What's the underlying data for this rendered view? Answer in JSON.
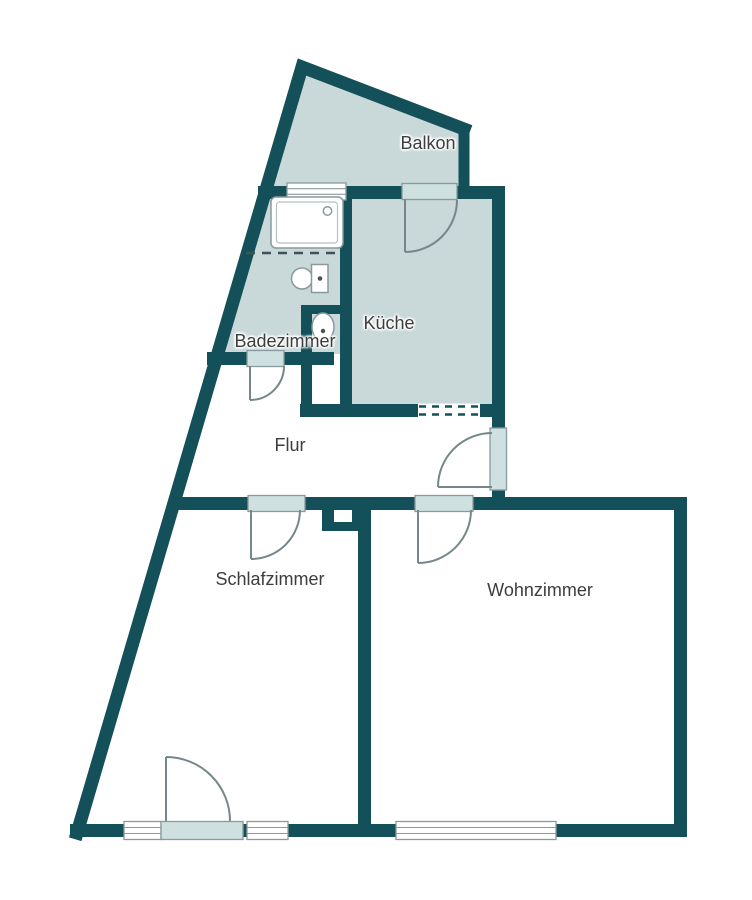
{
  "floorplan": {
    "type": "apartment-floor-plan",
    "rooms": {
      "balkon": {
        "label": "Balkon",
        "shaded": true
      },
      "kueche": {
        "label": "Küche",
        "shaded": true
      },
      "badezimmer": {
        "label": "Badezimmer",
        "shaded": true
      },
      "flur": {
        "label": "Flur",
        "shaded": false
      },
      "schlafzimmer": {
        "label": "Schlafzimmer",
        "shaded": false
      },
      "wohnzimmer": {
        "label": "Wohnzimmer",
        "shaded": false
      }
    },
    "symbols": [
      "shower-tub",
      "toilet",
      "sink",
      "door-swing",
      "window",
      "chimney",
      "pass-through-hatch",
      "sloped-ceiling-dashed-line"
    ]
  },
  "colors": {
    "wall": "#14505a",
    "shaded_room": "#c9d8d9",
    "door": "#cfe0e1",
    "fixture_stroke": "#8a999c",
    "arc": "#76878a",
    "label": "#3d3d3d",
    "background": "#ffffff"
  }
}
